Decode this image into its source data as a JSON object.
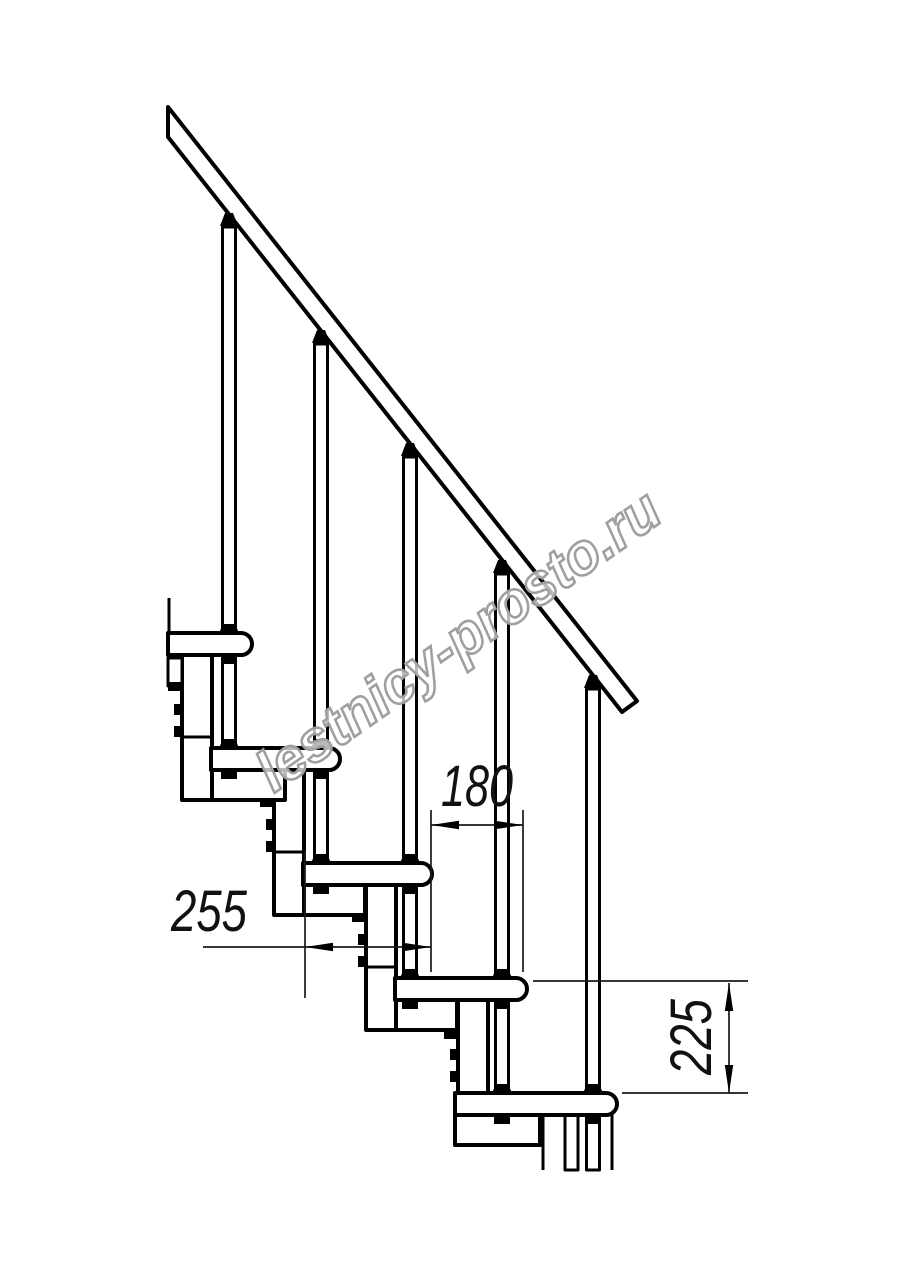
{
  "drawing": {
    "description": "Technical side-view line drawing of a modular staircase with handrail, balusters and five treads",
    "background_color": "#ffffff",
    "line_color": "#000000",
    "structure": {
      "treads": 5,
      "balusters": 5,
      "support_columns": 4
    },
    "dimensions": {
      "run": {
        "label": "180",
        "orientation": "horizontal"
      },
      "depth": {
        "label": "255",
        "orientation": "horizontal"
      },
      "rise": {
        "label": "225",
        "orientation": "vertical"
      }
    },
    "watermark": {
      "text": "lestnicy-prosto.ru",
      "color": "#9f9f9f",
      "angle_deg": -35
    }
  }
}
